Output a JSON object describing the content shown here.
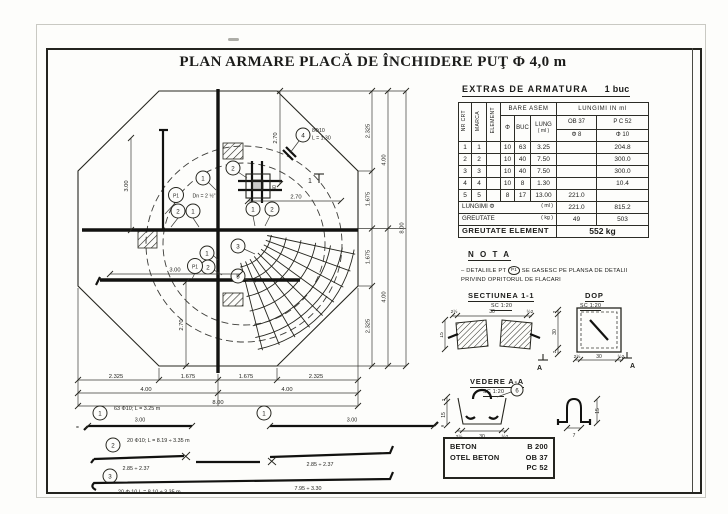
{
  "page": {
    "title": "PLAN ARMARE PLACĂ DE ÎNCHIDERE PUŢ Φ 4,0 m"
  },
  "plan": {
    "marks": {
      "m1": "1",
      "m2": "2",
      "m3": "3",
      "m4": "4",
      "m5": "5"
    },
    "p1": "P1",
    "p1_note": "Dn = 2 ½\"",
    "detail4_line1": "8Φ10",
    "detail4_line2": "L = 1.30",
    "section_cut": "1",
    "dim_300_left": "3.00",
    "dim_270_bottom": "2.70",
    "dim_300_bar": "3.00",
    "dim_270_top": "2.70",
    "dim_270_mid": "2.70",
    "dim_30_a": "30",
    "dim_30_b": "30",
    "dims_right": [
      "2.325",
      "1.675",
      "1.675",
      "2.325"
    ],
    "dims_right_mid": [
      "4.00",
      "4.00"
    ],
    "dim_right_total": "8.00",
    "dims_bottom": [
      "2.325",
      "1.675",
      "1.675",
      "2.325"
    ],
    "dims_bottom_mid": [
      "4.00",
      "4.00"
    ],
    "dim_bottom_total": "8.00"
  },
  "bars": {
    "b1": {
      "mark": "1",
      "label": "63 Φ10; L = 3.25 m",
      "dim": "3.00"
    },
    "b1r": {
      "mark": "1",
      "dim": "3.00"
    },
    "b2": {
      "mark": "2",
      "label": "20 Φ10; L = 8.19 ÷ 3.35 m",
      "dim_left": "2.85 ÷ 2.37",
      "dim_right": "2.85 ÷ 2.37"
    },
    "b3": {
      "mark": "3",
      "label": "20 Φ 10   L = 8.10 ÷ 3.35 m",
      "dim": "7.95 ÷ 3.30"
    }
  },
  "extras": {
    "title": "EXTRAS  DE  ARMATURA",
    "unit": "1 buc",
    "head": {
      "nr": "NR CRT",
      "marca": "MARCA",
      "element": "ELEMENT",
      "group_bare": "BARE ASEM",
      "group_lungimi": "LUNGIMI  IN  ml",
      "phi": "Φ",
      "buc": "BUC",
      "lung": "LUNG",
      "lung_unit": "( ml )",
      "ob": "OB 37",
      "pc": "P C 52",
      "ob_phi": "Φ 8",
      "pc_phi": "Φ 10"
    },
    "rows": [
      [
        "1",
        "1",
        "",
        "10",
        "63",
        "3.25",
        "",
        "204.8"
      ],
      [
        "2",
        "2",
        "",
        "10",
        "40",
        "7.50",
        "",
        "300.0"
      ],
      [
        "3",
        "3",
        "",
        "10",
        "40",
        "7.50",
        "",
        "300.0"
      ],
      [
        "4",
        "4",
        "",
        "10",
        "8",
        "1.30",
        "",
        "10.4"
      ],
      [
        "5",
        "5",
        "",
        "8",
        "17",
        "13.00",
        "221.0",
        ""
      ]
    ],
    "footer": {
      "lungimi": "LUNGIMI Φ",
      "lungimi_unit": "( ml )",
      "lungimi_ob": "221.0",
      "lungimi_pc": "815.2",
      "greutate": "GREUTATE",
      "greutate_unit": "( kg )",
      "greutate_ob": "49",
      "greutate_pc": "503",
      "element": "GREUTATE  ELEMENT",
      "element_value": "552 kg"
    }
  },
  "nota": {
    "title": "N O T A",
    "prefix": "– DETALIILE PT",
    "p1": "P1",
    "suffix": "SE GASESC PE PLANSA DE DETALII",
    "line2": "PRIVIND OPRITORUL DE FLACARI"
  },
  "sectiunea": {
    "title": "SECTIUNEA 1-1",
    "scale": "SC 1:20",
    "dim_left": "15",
    "dims_top": [
      "2½",
      "30",
      "½2"
    ]
  },
  "dop": {
    "title": "DOP",
    "scale": "SC 1:20",
    "dim_right": "30",
    "dim_right_end_top": "2",
    "dim_right_end_bot": "2",
    "dims_bottom": [
      "2½",
      "30",
      "½2"
    ],
    "marker": "A"
  },
  "vedere": {
    "title": "VEDERE A-A",
    "scale": "SC 1:20",
    "mark": "6",
    "dim_left_top": "2",
    "dim_left_bot": "15",
    "dims_bottom": [
      "2½",
      "30",
      "½2"
    ],
    "hook_dim_right": "15",
    "hook_dim_bottom": "7"
  },
  "materials": {
    "r1l": "BETON",
    "r1v": "B 200",
    "r2l": "OTEL BETON",
    "r2v": "OB 37",
    "r3l": "",
    "r3v": "PC 52"
  }
}
